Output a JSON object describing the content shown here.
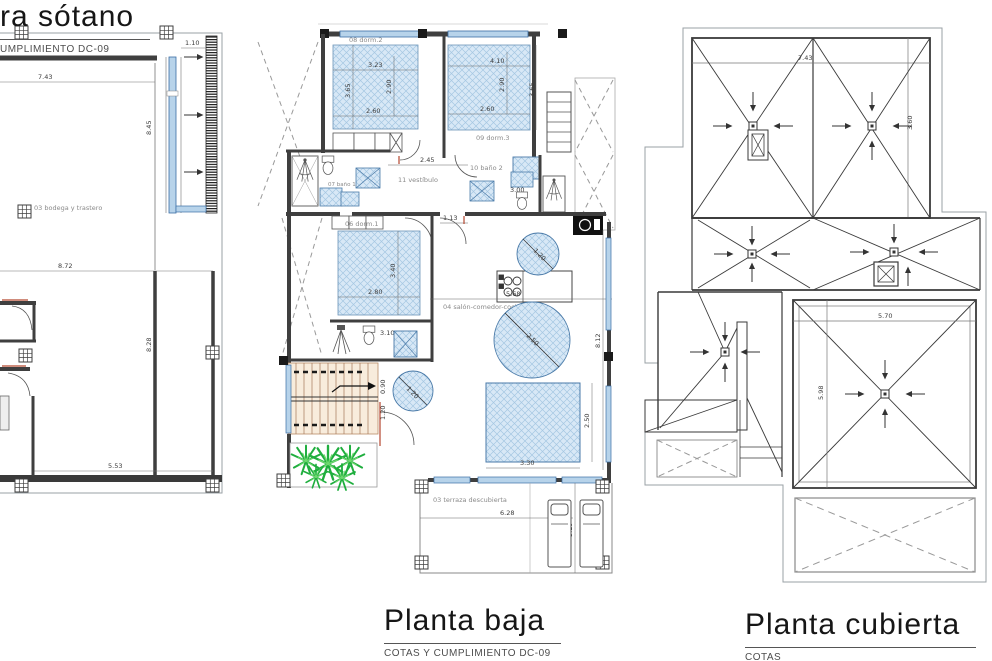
{
  "titles": {
    "sotano": {
      "title": "ra sótano",
      "subtitle": "UMPLIMIENTO DC-09"
    },
    "baja": {
      "title": "Planta baja",
      "subtitle": "COTAS Y CUMPLIMIENTO DC-09"
    },
    "cubierta": {
      "title": "Planta cubierta",
      "subtitle": "COTAS"
    }
  },
  "sotano": {
    "room_bodega": "03 bodega y trastero",
    "dims": {
      "top": "7.43",
      "window": "1.10",
      "right_v": "8.45",
      "mid": "8.72",
      "height": "8.28",
      "bottom": "5.53"
    }
  },
  "baja": {
    "rooms": {
      "dorm2": "08 dorm.2",
      "dorm3": "09 dorm.3",
      "bano2": "10 baño 2",
      "vestibulo": "11 vestíbulo",
      "bano1": "07 baño 1",
      "dorm1": "06 dorm.1",
      "salon": "04 salón-comedor-cocina",
      "terraza": "03 terraza descubierta"
    },
    "dims": {
      "d2_w": "3.23",
      "d2_w2": "2.60",
      "d2_h": "3.65",
      "d2_h2": "2.90",
      "d3_w": "4.10",
      "d3_w2": "2.60",
      "d3_h": "2.90",
      "d3_h2": "3.65",
      "vest": "2.45",
      "hall": "1.13",
      "bano2_w": "3.00",
      "bano3": "3.10",
      "d1_w": "2.80",
      "d1_h": "3.40",
      "salon_w": "5.68",
      "salon_h": "8.12",
      "circle_small": "1.20",
      "circle_big": "2.50",
      "circle_stairs": "1.20",
      "pool_w": "3.30",
      "pool_h": "2.50",
      "terr_w": "6.28",
      "terr_h": "3.19",
      "stair_a": "0.90",
      "stair_b": "1.20"
    }
  },
  "cubierta": {
    "dims": {
      "top": "7.43",
      "right": "3.60",
      "sq_w": "5.70",
      "sq_h": "5.98"
    }
  }
}
